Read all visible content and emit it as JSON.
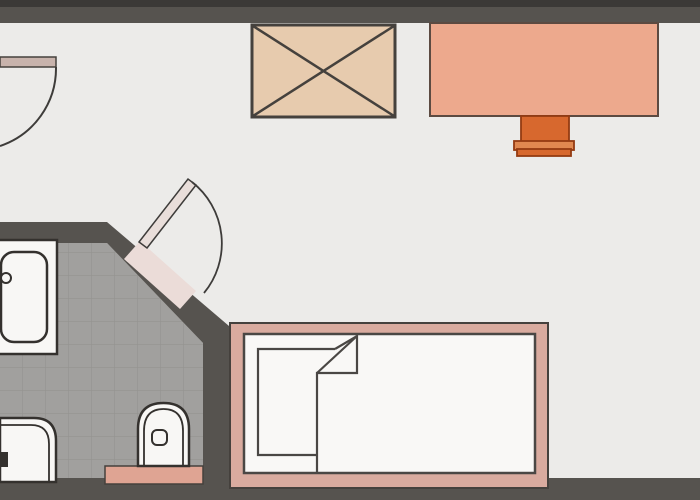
{
  "document": {
    "type": "architectural-floor-plan",
    "description": "studio apartment floor plan with bathroom, bed, desk with chair, wardrobe and two swing doors",
    "visible_text": []
  },
  "elements": {
    "main_room": "main room floor",
    "bathroom": "tiled bathroom",
    "entry_door": "entry swing door (top left)",
    "bathroom_door": "bathroom swing door on diagonal wall",
    "wardrobe": "wardrobe / closet (crossed box symbol)",
    "desk": "desk against top wall",
    "chair": "desk chair tucked under desk",
    "bed": "single bed with folded blanket corner",
    "sink": "bathroom sink with counter",
    "toilet": "toilet",
    "bidet": "bidet / fixture at bottom left"
  },
  "colors": {
    "floor_main": "#ECEBE9",
    "floor_bath": "#A1A09E",
    "tile_line": "#949390",
    "wall": "#56534F",
    "wall_dark": "#3B3937",
    "outline": "#45413D",
    "fixture_outline": "#34312E",
    "fixture_fill": "#F8F7F5",
    "wardrobe_fill": "#E7CBAE",
    "desk_fill": "#EDA98D",
    "desk_outline": "#5C4A41",
    "chair_fill": "#D7682E",
    "chair_band": "#E08850",
    "chair_outline": "#943B12",
    "bed_frame": "#D9AB9F",
    "mattress_fill": "#F9F8F6",
    "blanket_line": "#4A4744",
    "entry_door_leaf": "#C8B3AC",
    "bath_door_leaf": "#E9DEDA",
    "threshold_diagonal": "#EBDCD8",
    "threshold_salmon": "#DFA493",
    "arc_stroke": "#3E3C3A"
  }
}
